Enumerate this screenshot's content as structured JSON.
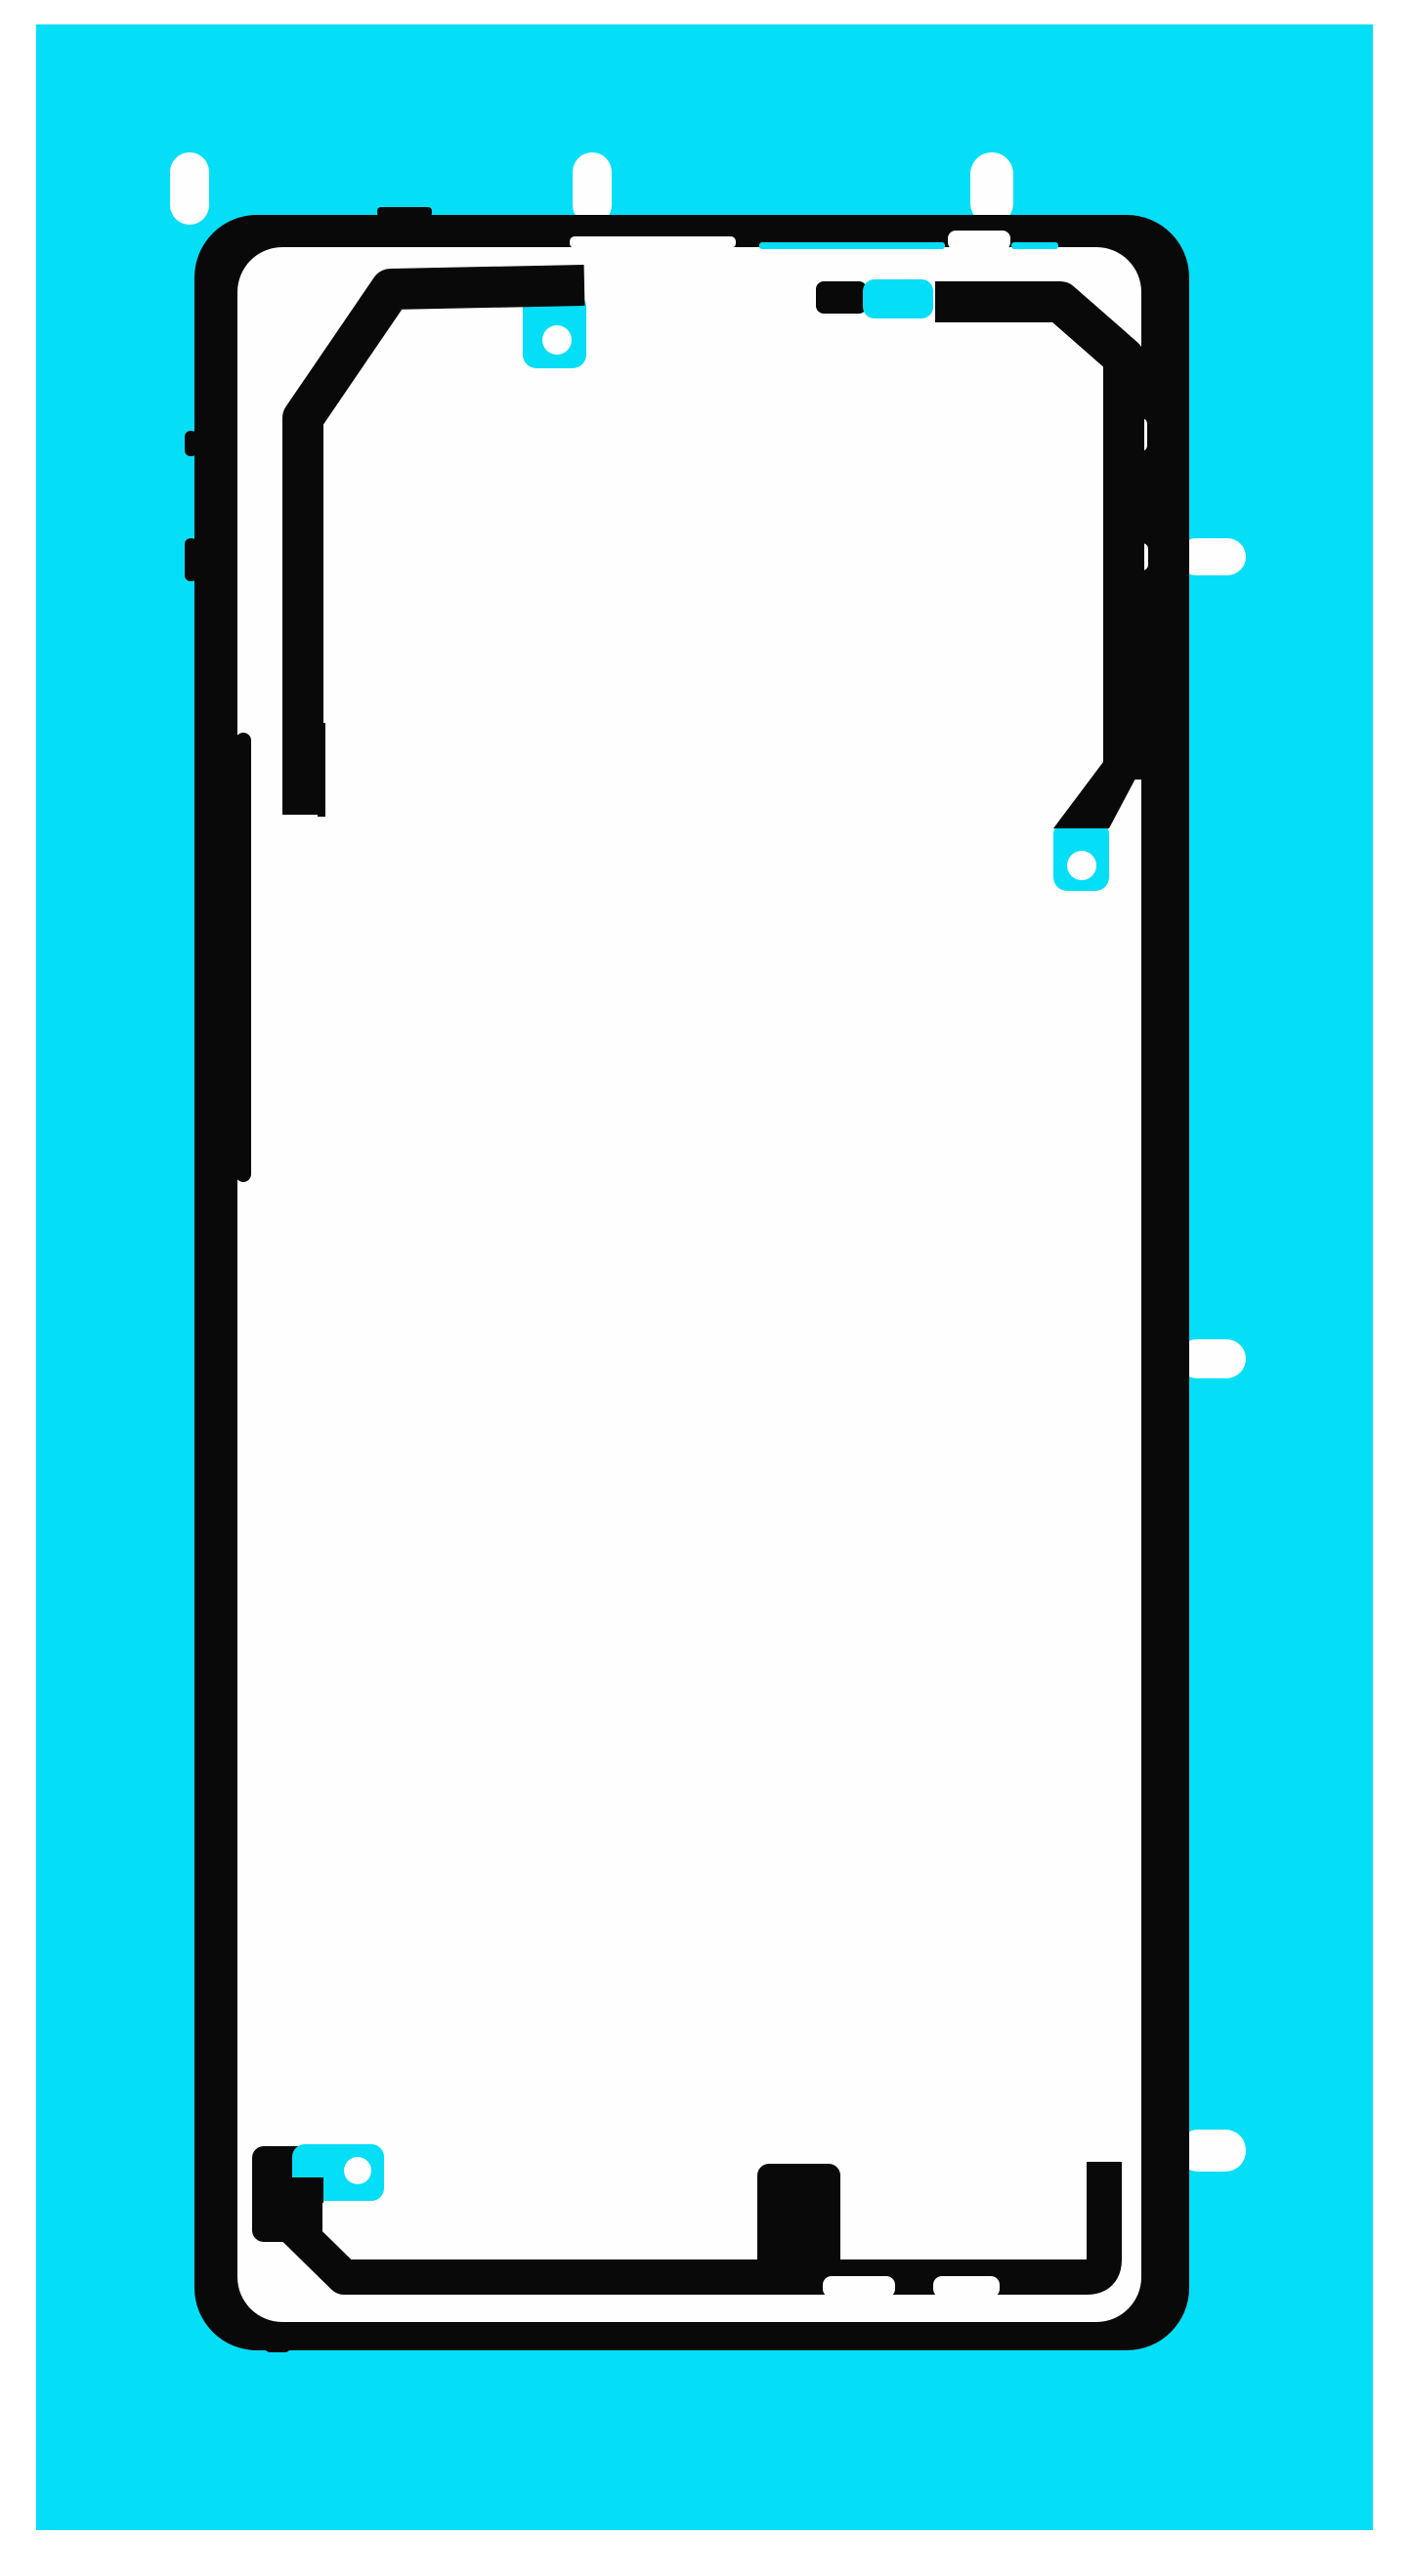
{
  "figure": {
    "alt": "Back cover adhesive sticker sheet: black pre-cut phone-shaped adhesive frame on a bright cyan release liner with white pull tabs and round alignment-hole cutouts"
  },
  "colors": {
    "page_white": "#ffffff",
    "liner_cyan": "#05def7",
    "adhesive_black": "#090909",
    "cutout_white": "#fefefe"
  },
  "counts": {
    "top_pull_tabs": 3,
    "side_pull_tabs": 3,
    "alignment_holes": 3
  }
}
